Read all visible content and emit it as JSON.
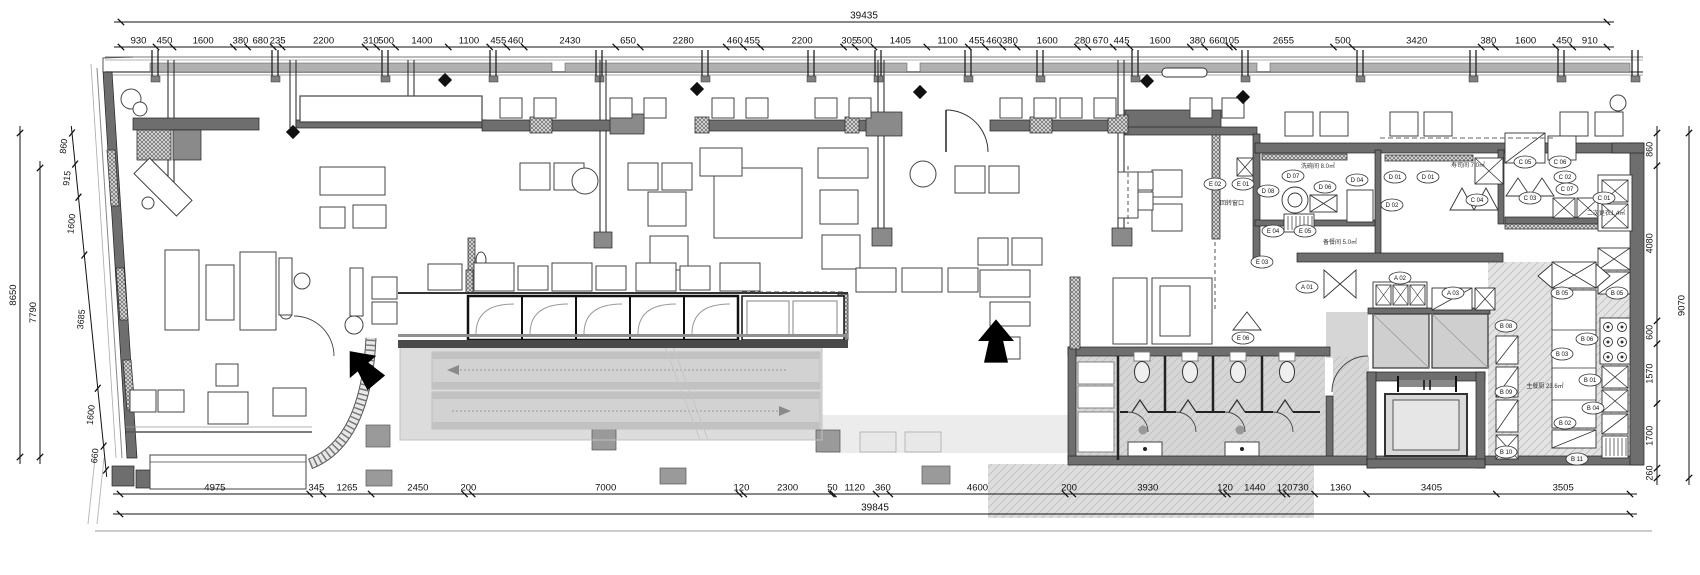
{
  "drawing": {
    "type": "restaurant-floor-plan-cad",
    "dimensions": {
      "top_total": "39435",
      "top": [
        "930",
        "450",
        "1600",
        "380",
        "680",
        "235",
        "2200",
        "310",
        "500",
        "1400",
        "1100",
        "455",
        "460",
        "2430",
        "650",
        "2280",
        "460",
        "455",
        "2200",
        "305",
        "500",
        "1405",
        "1100",
        "455",
        "460",
        "380",
        "1600",
        "280",
        "670",
        "445",
        "1600",
        "380",
        "660",
        "105",
        "2655",
        "500",
        "3420",
        "380",
        "1600",
        "450",
        "910"
      ],
      "bottom_total": "39845",
      "bottom": [
        "4975",
        "345",
        "1265",
        "2450",
        "200",
        "7000",
        "120",
        "2300",
        "50",
        "1120",
        "360",
        "4600",
        "200",
        "3930",
        "120",
        "1440",
        "120",
        "730",
        "1360",
        "3405",
        "3505"
      ],
      "left": [
        "860",
        "915",
        "1600",
        "3685",
        "1600",
        "660"
      ],
      "left_total_outer": "8650",
      "left_total_inner": "7790",
      "right": [
        "860",
        "4080",
        "600",
        "1570",
        "1700",
        "260"
      ],
      "right_total": "9070"
    },
    "room_labels": [
      {
        "text": "洗碗间 8.0㎡",
        "x": 1318,
        "y": 168
      },
      {
        "text": "寿司间 7.0㎡",
        "x": 1468,
        "y": 167
      },
      {
        "text": "备餐间 5.0㎡",
        "x": 1340,
        "y": 244
      },
      {
        "text": "回转窗口",
        "x": 1232,
        "y": 205
      },
      {
        "text": "二次更衣1.4㎡",
        "x": 1606,
        "y": 215
      },
      {
        "text": "主餐厨 23.6㎡",
        "x": 1545,
        "y": 388
      }
    ],
    "equipment_tags": [
      {
        "text": "A 01",
        "x": 1307,
        "y": 287
      },
      {
        "text": "A 02",
        "x": 1400,
        "y": 278
      },
      {
        "text": "A 03",
        "x": 1453,
        "y": 293
      },
      {
        "text": "B 01",
        "x": 1590,
        "y": 380
      },
      {
        "text": "B 02",
        "x": 1565,
        "y": 423
      },
      {
        "text": "B 03",
        "x": 1562,
        "y": 354
      },
      {
        "text": "B 04",
        "x": 1593,
        "y": 408
      },
      {
        "text": "B 05",
        "x": 1562,
        "y": 293
      },
      {
        "text": "B 05",
        "x": 1617,
        "y": 293
      },
      {
        "text": "B 06",
        "x": 1587,
        "y": 339
      },
      {
        "text": "B 08",
        "x": 1506,
        "y": 326
      },
      {
        "text": "B 09",
        "x": 1506,
        "y": 392
      },
      {
        "text": "B 10",
        "x": 1506,
        "y": 452
      },
      {
        "text": "B 11",
        "x": 1577,
        "y": 459
      },
      {
        "text": "C 01",
        "x": 1604,
        "y": 198
      },
      {
        "text": "C 02",
        "x": 1565,
        "y": 177
      },
      {
        "text": "C 03",
        "x": 1530,
        "y": 198
      },
      {
        "text": "C 04",
        "x": 1477,
        "y": 200
      },
      {
        "text": "C 05",
        "x": 1525,
        "y": 162
      },
      {
        "text": "C 06",
        "x": 1560,
        "y": 162
      },
      {
        "text": "C 07",
        "x": 1567,
        "y": 189
      },
      {
        "text": "D 01",
        "x": 1395,
        "y": 177
      },
      {
        "text": "D 01",
        "x": 1428,
        "y": 177
      },
      {
        "text": "D 02",
        "x": 1392,
        "y": 205
      },
      {
        "text": "D 04",
        "x": 1357,
        "y": 180
      },
      {
        "text": "D 06",
        "x": 1325,
        "y": 187
      },
      {
        "text": "D 07",
        "x": 1293,
        "y": 176
      },
      {
        "text": "D 08",
        "x": 1268,
        "y": 191
      },
      {
        "text": "E 01",
        "x": 1243,
        "y": 184
      },
      {
        "text": "E 02",
        "x": 1215,
        "y": 184
      },
      {
        "text": "E 03",
        "x": 1262,
        "y": 262
      },
      {
        "text": "E 04",
        "x": 1273,
        "y": 231
      },
      {
        "text": "E 05",
        "x": 1305,
        "y": 231
      },
      {
        "text": "E 06",
        "x": 1243,
        "y": 338
      }
    ],
    "colors": {
      "wall": "#6e6e6e",
      "floor_tint": "#d6d6d6",
      "escalator_tint": "#dcdcdc",
      "ink": "#222222"
    }
  }
}
